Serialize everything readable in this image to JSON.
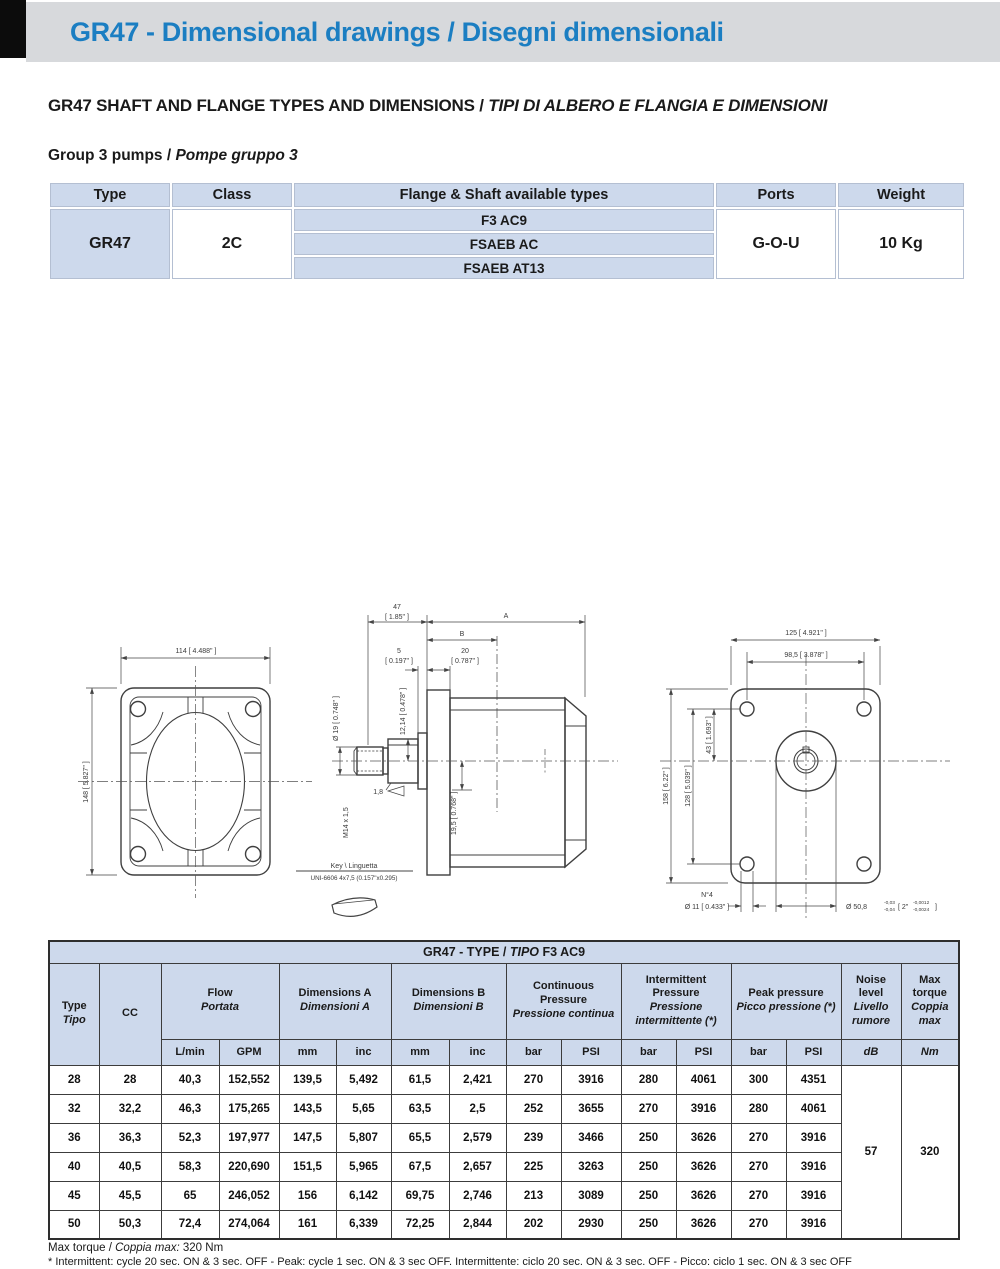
{
  "header": {
    "title": "GR47 - Dimensional drawings / Disegni dimensionali"
  },
  "headings": {
    "section_en": "GR47 SHAFT AND FLANGE TYPES AND  DIMENSIONS / ",
    "section_it": "TIPI DI ALBERO E FLANGIA E DIMENSIONI",
    "group_en": "Group 3 pumps / ",
    "group_it": "Pompe gruppo 3"
  },
  "spec_table": {
    "col_type": "Type",
    "col_class": "Class",
    "col_flange": "Flange & Shaft available types",
    "col_ports": "Ports",
    "col_weight": "Weight",
    "type": "GR47",
    "class": "2C",
    "flange_types": [
      "F3 AC9",
      "FSAEB AC",
      "FSAEB AT13"
    ],
    "ports": "G-O-U",
    "weight": "10 Kg"
  },
  "drawings": {
    "front": {
      "dim_width": "114 [ 4.488\" ]",
      "dim_height": "148 [ 5.827\" ]"
    },
    "side": {
      "dim_47": "47",
      "dim_47_in": "[ 1.85\" ]",
      "dim_a": "A",
      "dim_b": "B",
      "dim_5": "5",
      "dim_5_in": "[ 0.197\" ]",
      "dim_20": "20",
      "dim_20_in": "[ 0.787\" ]",
      "dim_shaft_dia": "Ø 19 [ 0.748\" ]",
      "dim_key_flat": "12,14 [ 0.478\" ]",
      "thread": "M14 x 1,5",
      "chamfer": "1,8",
      "dim_port": "19,5 [ 0.768\" ]",
      "key_label": "Key \\ Linguetta",
      "key_spec": "UNI-6606 4x7,5 (0.157\"x0.295)"
    },
    "rear": {
      "dim_width": "125 [ 4.921\" ]",
      "dim_bolt_h": "98,5 [ 3.878\" ]",
      "dim_height": "158 [ 6.22\" ]",
      "dim_bolt_v": "128 [ 5.039\" ]",
      "dim_43": "43 [ 1.693\" ]",
      "holes_count": "N°4",
      "holes_dia": "Ø 11 [ 0.433\" ]",
      "pilot_dia": "Ø  50,8",
      "pilot_tol_top": "-0,03",
      "pilot_tol_bot": "-0,04",
      "pilot_in_open": "[ 2\"",
      "pilot_in_tol_top": "-0,0012",
      "pilot_in_tol_bot": "-0,0024",
      "pilot_close": "]"
    }
  },
  "data_table": {
    "title_pre": "GR47 - TYPE / ",
    "title_it": "TIPO",
    "title_post": " F3 AC9",
    "col_type_en": "Type",
    "col_type_it": "Tipo",
    "col_cc": "CC",
    "groups": {
      "flow_en": "Flow",
      "flow_it": "Portata",
      "dima_en": "Dimensions A",
      "dima_it": "Dimensioni A",
      "dimb_en": "Dimensions B",
      "dimb_it": "Dimensioni B",
      "cont_en": "Continuous Pressure",
      "cont_it": "Pressione continua",
      "int_en": "Intermittent Pressure",
      "int_it": "Pressione intermittente (*)",
      "peak_en": "Peak pressure",
      "peak_it": "Picco pressione (*)",
      "noise_en": "Noise level",
      "noise_it": "Livello rumore",
      "torque_en": "Max torque",
      "torque_it": "Coppia max"
    },
    "units": {
      "flow1": "L/min",
      "flow2": "GPM",
      "dima1": "mm",
      "dima2": "inc",
      "dimb1": "mm",
      "dimb2": "inc",
      "cont1": "bar",
      "cont2": "PSI",
      "int1": "bar",
      "int2": "PSI",
      "peak1": "bar",
      "peak2": "PSI",
      "noise": "dB",
      "torque": "Nm"
    },
    "rows": [
      [
        "28",
        "28",
        "40,3",
        "152,552",
        "139,5",
        "5,492",
        "61,5",
        "2,421",
        "270",
        "3916",
        "280",
        "4061",
        "300",
        "4351"
      ],
      [
        "32",
        "32,2",
        "46,3",
        "175,265",
        "143,5",
        "5,65",
        "63,5",
        "2,5",
        "252",
        "3655",
        "270",
        "3916",
        "280",
        "4061"
      ],
      [
        "36",
        "36,3",
        "52,3",
        "197,977",
        "147,5",
        "5,807",
        "65,5",
        "2,579",
        "239",
        "3466",
        "250",
        "3626",
        "270",
        "3916"
      ],
      [
        "40",
        "40,5",
        "58,3",
        "220,690",
        "151,5",
        "5,965",
        "67,5",
        "2,657",
        "225",
        "3263",
        "250",
        "3626",
        "270",
        "3916"
      ],
      [
        "45",
        "45,5",
        "65",
        "246,052",
        "156",
        "6,142",
        "69,75",
        "2,746",
        "213",
        "3089",
        "250",
        "3626",
        "270",
        "3916"
      ],
      [
        "50",
        "50,3",
        "72,4",
        "274,064",
        "161",
        "6,339",
        "72,25",
        "2,844",
        "202",
        "2930",
        "250",
        "3626",
        "270",
        "3916"
      ]
    ],
    "noise_value": "57",
    "torque_value": "320"
  },
  "notes": {
    "torque_pre": "Max torque / ",
    "torque_it": "Coppia max:",
    "torque_post": " 320 Nm",
    "intermittent": "* Intermittent: cycle 20 sec. ON & 3 sec. OFF - Peak: cycle 1 sec. ON & 3 sec OFF. Intermittente: ciclo 20 sec. ON & 3 sec. OFF - Picco: ciclo 1 sec. ON & 3 sec OFF"
  },
  "colors": {
    "accent_blue": "#1b7ec2",
    "band_gray": "#d7d9dc",
    "cell_blue": "#cdd9ec"
  }
}
